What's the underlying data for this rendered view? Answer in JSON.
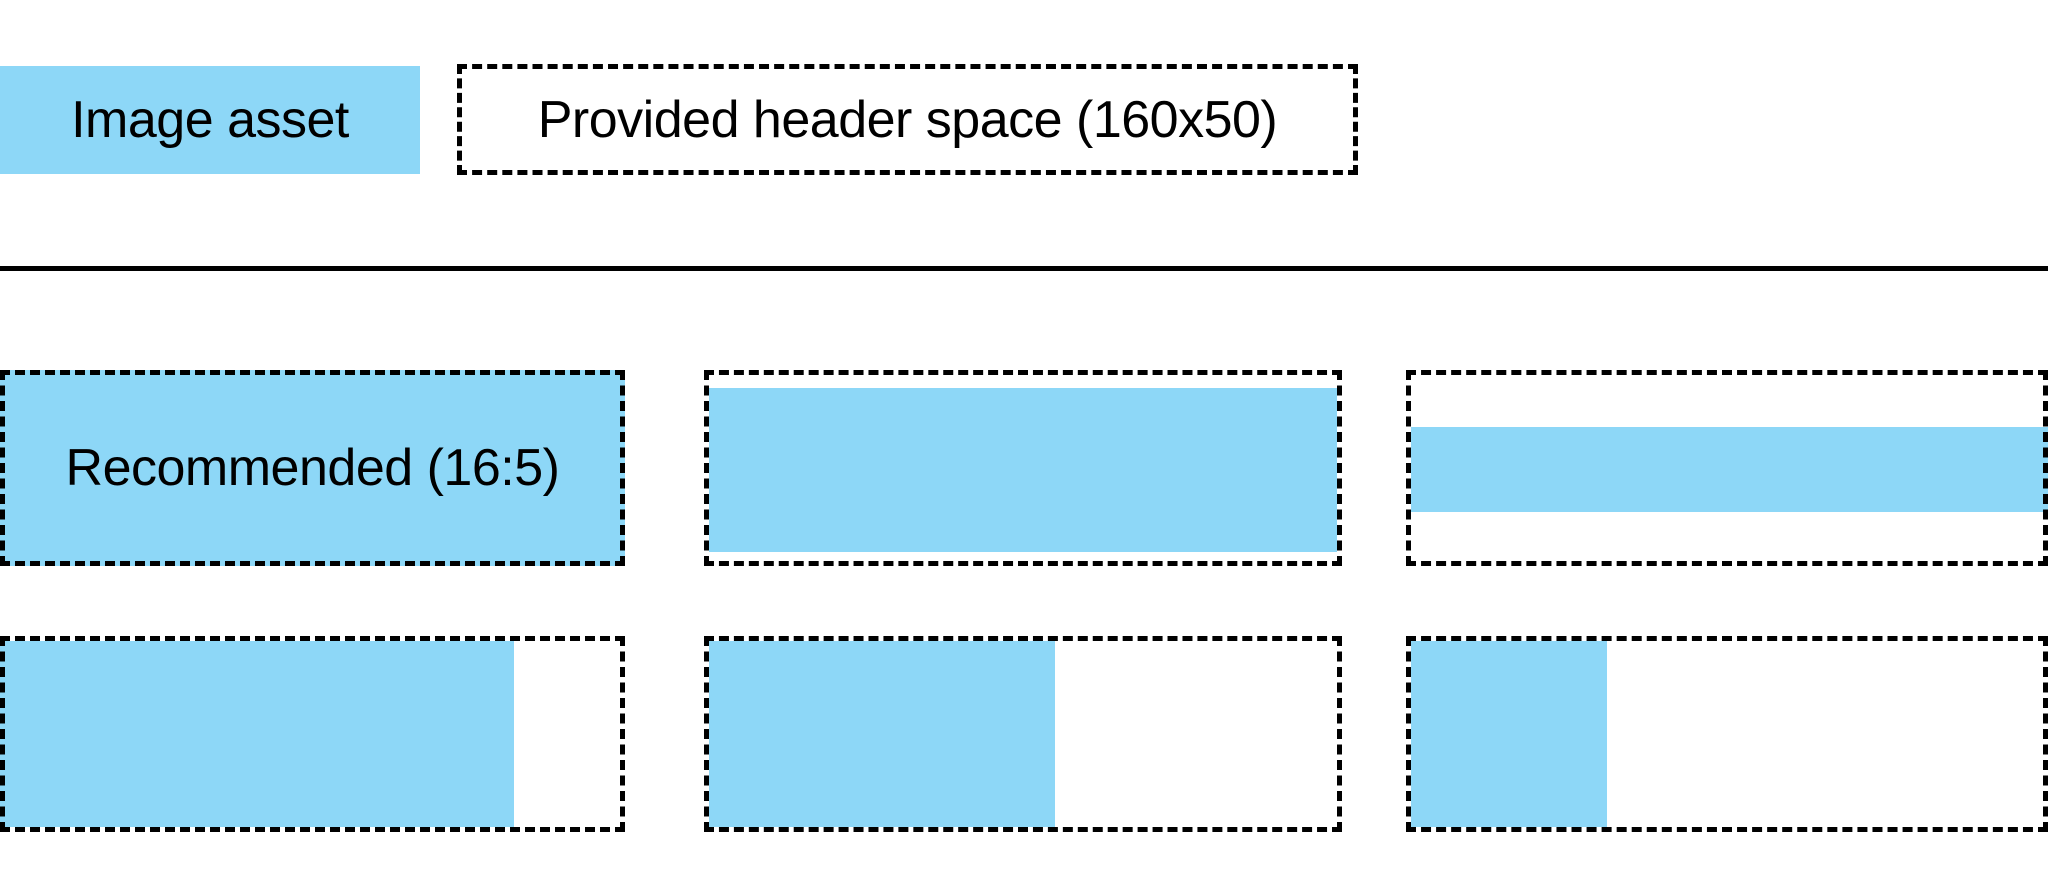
{
  "canvas": {
    "width": 2048,
    "height": 896,
    "background": "#ffffff"
  },
  "colors": {
    "asset_blue": "#8DD7F7",
    "outline_black": "#000000",
    "divider_black": "#000000",
    "text_black": "#000000"
  },
  "legend": {
    "swatch_label": "Image asset",
    "header_space_label": "Provided header space (160x50)"
  },
  "examples": [
    {
      "name": "recommended-16-5",
      "label": "Recommended (16:5)",
      "box": {
        "x": 0,
        "y": 370,
        "w": 625,
        "h": 196
      },
      "fill": {
        "x": 0,
        "y": 370,
        "w": 625,
        "h": 196
      }
    },
    {
      "name": "full-width-shorter",
      "label": "",
      "box": {
        "x": 704,
        "y": 370,
        "w": 638,
        "h": 196
      },
      "fill": {
        "x": 709,
        "y": 388,
        "w": 628,
        "h": 164
      }
    },
    {
      "name": "thin-horizontal-band",
      "label": "",
      "box": {
        "x": 1406,
        "y": 370,
        "w": 642,
        "h": 196
      },
      "fill": {
        "x": 1411,
        "y": 427,
        "w": 637,
        "h": 85
      }
    },
    {
      "name": "partial-width-80",
      "label": "",
      "box": {
        "x": 0,
        "y": 636,
        "w": 625,
        "h": 196
      },
      "fill": {
        "x": 0,
        "y": 641,
        "w": 514,
        "h": 186
      }
    },
    {
      "name": "partial-width-55",
      "label": "",
      "box": {
        "x": 704,
        "y": 636,
        "w": 638,
        "h": 196
      },
      "fill": {
        "x": 709,
        "y": 641,
        "w": 346,
        "h": 186
      }
    },
    {
      "name": "partial-width-30",
      "label": "",
      "box": {
        "x": 1406,
        "y": 636,
        "w": 642,
        "h": 196
      },
      "fill": {
        "x": 1411,
        "y": 641,
        "w": 196,
        "h": 186
      }
    }
  ]
}
